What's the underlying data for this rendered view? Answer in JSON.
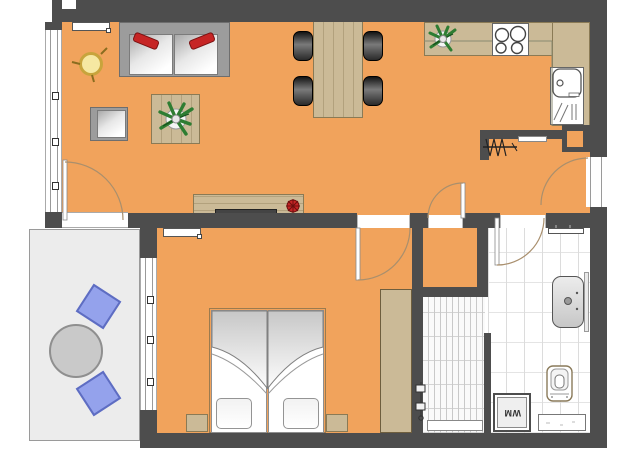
{
  "labels": {
    "washing_machine": "WM"
  },
  "palette": {
    "floor_orange": "#F1A35C",
    "wall_gray": "#4D4D4D",
    "wood_tan": "#CBBA97",
    "terrace_gray": "#ECECEC",
    "terrace_chair_blue": "#94A2EC",
    "sofa_pillow_red": "#C62525",
    "plant_green": "#2E7D32",
    "side_table_yellow": "#F6E8A2",
    "dining_chair_black": "#1a1a1a",
    "bath_tile_white": "#FFFFFF"
  },
  "symbols": [
    "sofa",
    "red-pillow",
    "armchair",
    "side-table",
    "coffee-table",
    "potted-plant",
    "dining-table",
    "dining-chair",
    "kitchen-counter",
    "stove",
    "kitchen-sink",
    "coat-rack",
    "sideboard",
    "tv",
    "red-flower",
    "radiator",
    "door-arc",
    "window",
    "double-bed",
    "night-stand",
    "wardrobe",
    "terrace-table",
    "terrace-chair",
    "walk-in-shower",
    "shower-valve",
    "washbasin",
    "toilet",
    "washing-machine",
    "bath-shelf",
    "duct-shaft"
  ]
}
